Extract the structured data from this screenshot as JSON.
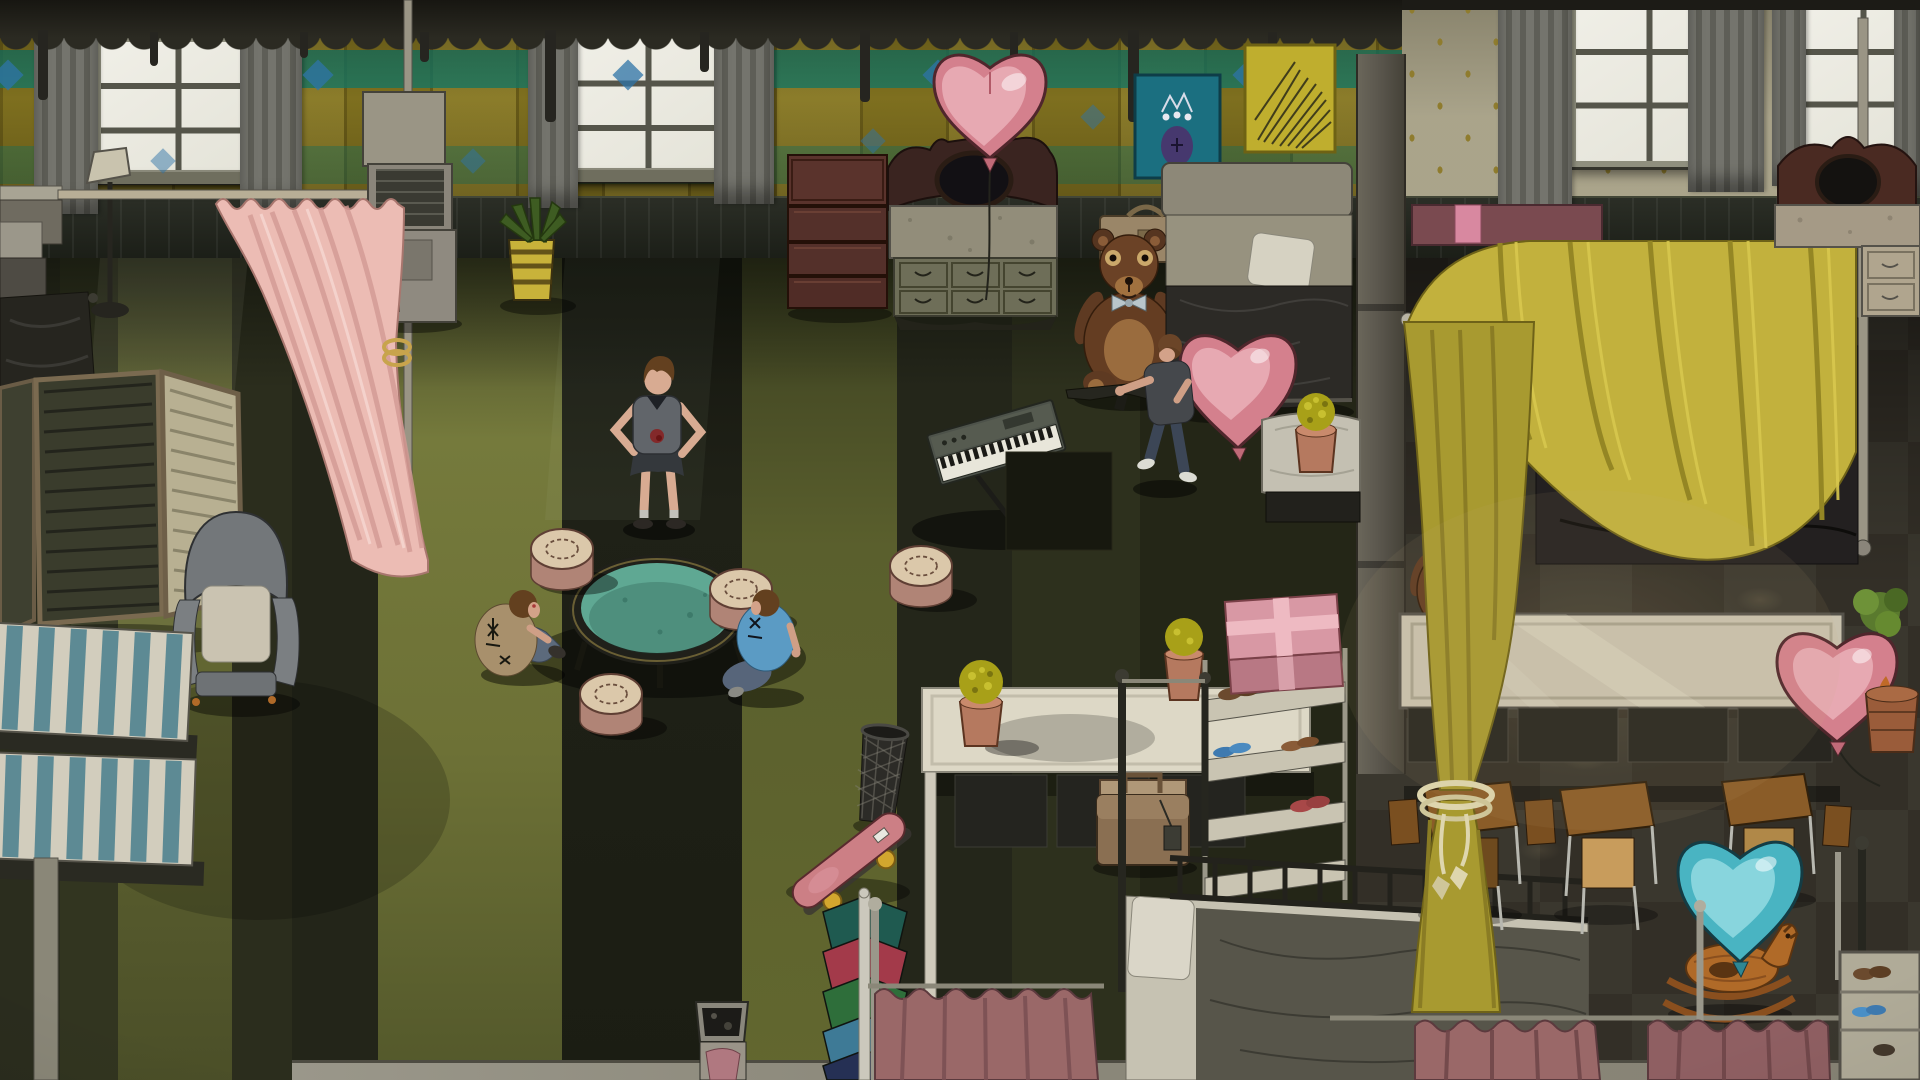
{
  "meta": {
    "domain": "Game",
    "description": "Hand-painted top-down/isometric game scene of a run-down dormitory decorated with heart balloons and teddy bears; no HUD or visible text",
    "resolution": "1920x1080",
    "visible_text": []
  },
  "palette": {
    "heart_pink": "#d4808d",
    "heart_pink_light": "#eab0b8",
    "heart_blue": "#49b4c2",
    "heart_blue_light": "#8fd8e0",
    "canopy_yellow": "#c2b13d",
    "canopy_yellow_dark": "#a89a30",
    "curtain_pink": "#ecbcb4",
    "curtain_rose": "#9a6868",
    "curtain_gray": "#6f6f68",
    "table_teal": "#5fa893",
    "stump_top": "#dbc8aa",
    "stump_side": "#b08476",
    "teddy_brown": "#643d22",
    "teddy_belly": "#9a6c3e",
    "wood_red": "#54302a",
    "counter_white": "#ddd8c6",
    "floor_light_band": "#6b6f35",
    "floor_dark_band": "#1e2016",
    "floor_right_charcoal": "#37342c",
    "wallpaper_mustard": "#8a7a22",
    "wallpaper_teal_stripe": "#168470",
    "wallpaper_cream": "#b2ac92",
    "window_glass": "#ecebe2",
    "skin": "#d8ab92",
    "jeans": "#5a6878",
    "shirt_blue": "#5b9bc4",
    "jacket_tan": "#a8906c",
    "skateboard_pink": "#cc7f85",
    "poster_teal": "#1b6f80",
    "poster_yellow": "#bfae2e"
  },
  "scene": {
    "left_room": {
      "wallpaper": "mustard plaid with teal stripes and blue diamonds",
      "windows": 2,
      "floor": "striped olive-green carpet",
      "valance": "dark tattered lace pelmet across ceiling"
    },
    "right_room": {
      "wallpaper": "cream with gold diamond ornaments",
      "windows": 2,
      "floor": "dark charcoal checkered carpet with sunlit patches",
      "divider": "gray concrete pillar"
    },
    "characters": [
      {
        "name": "girl-standing",
        "pose": "hands on hips",
        "outfit": "gray shirt with blood stain, dark shorts, gray socks",
        "zone": "center dark stripe"
      },
      {
        "name": "boy-tan-jacket",
        "pose": "sitting cross-legged at table",
        "outfit": "tan jacket with black star doodles, jeans",
        "zone": "left of round table"
      },
      {
        "name": "boy-blue-shirt",
        "pose": "sitting at table",
        "outfit": "blue t-shirt with black doodles, jeans",
        "zone": "right of round table"
      },
      {
        "name": "man-with-rifle",
        "pose": "walking, rifle lowered",
        "outfit": "dark gray tee, jeans, white sneakers",
        "zone": "upper center-right"
      }
    ],
    "balloons": [
      {
        "name": "heart-balloon-pink-over-vanity",
        "color": "pink"
      },
      {
        "name": "heart-balloon-pink-by-bed",
        "color": "pink"
      },
      {
        "name": "heart-balloon-pink-by-planter",
        "color": "pink"
      },
      {
        "name": "heart-balloon-blue",
        "color": "teal-blue"
      }
    ],
    "furniture": [
      "gray striped window curtains",
      "pink tied-back curtain on rail",
      "tall AC-heater unit",
      "aloe plant in yellow striped pot",
      "floor lamp",
      "gray cabinet",
      "folding screen (3 panels)",
      "gray wingback armchair",
      "two blue-striped mattresses",
      "dark bed top-left",
      "red-brown chest of drawers",
      "vanity dresser with black oval mirror",
      "six-drawer olive dresser",
      "teal poster with purple figure",
      "yellow poster with dried plant",
      "tan suitcase",
      "giant teddy bear with bow tie",
      "bed with gray headboard, white pillow, dark blanket",
      "nightstand with white cloth and potted yellow plant",
      "electric keyboard on X-stand",
      "round teal table",
      "four log stump stools",
      "long white counter with potted plants",
      "wire trash basket",
      "pink skateboard with yellow wheels",
      "clothes rack with five jackets",
      "metal crate with pink cloth",
      "brown briefcase with tag",
      "pink gift box with ribbon",
      "shoe shelf with shoes and flip-flops",
      "metal-frame bed with gray blanket",
      "dusty-rose privacy curtains on rails",
      "yellow canopy bed with rope tieback",
      "mauve wall shelf with pink box",
      "second vanity with oval mirror",
      "beige dresser",
      "three school desks with chairs",
      "small teddy bear",
      "wooden rocking horse",
      "green bush",
      "terracotta planter with rust plant",
      "small shoe rack bottom-right"
    ]
  }
}
